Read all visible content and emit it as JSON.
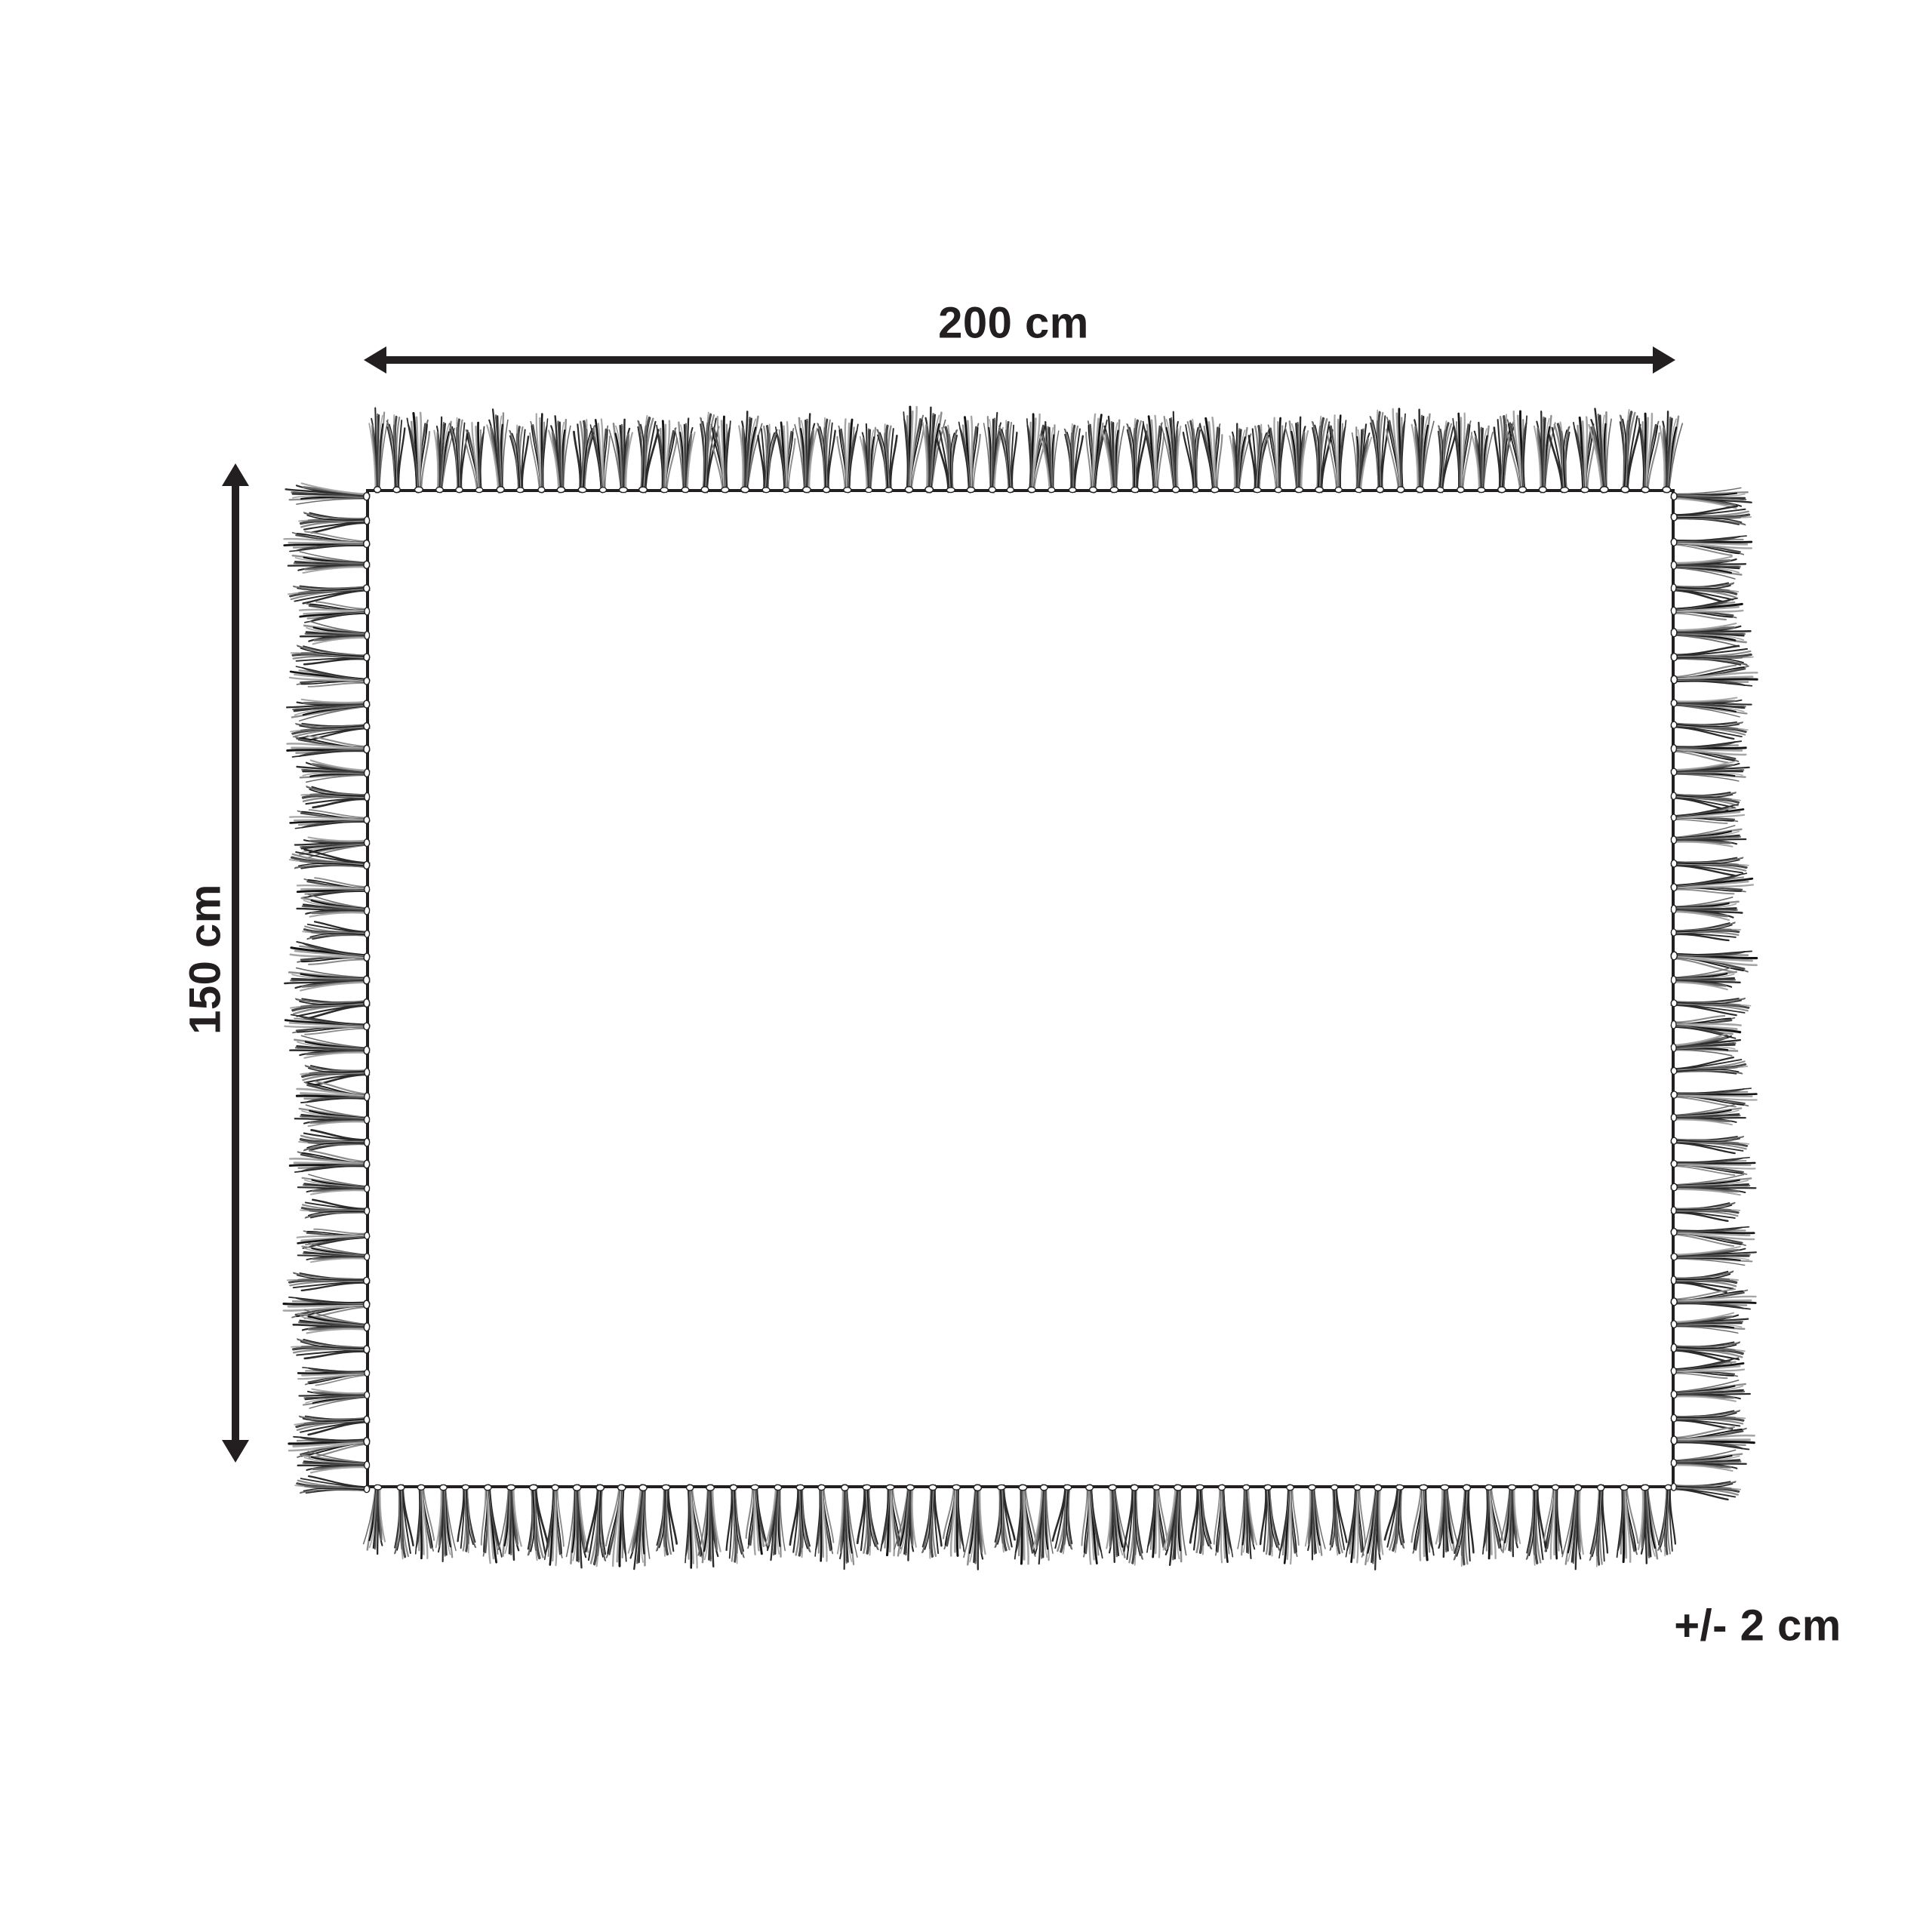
{
  "diagram": {
    "type": "product-dimension-diagram",
    "shape": "rectangle-with-fringe",
    "labels": {
      "width": "200 cm",
      "height": "150 cm",
      "tolerance": "+/- 2 cm"
    },
    "measurements": {
      "width_cm": 200,
      "height_cm": 150,
      "tolerance_cm": 2
    },
    "colors": {
      "ink": "#231f20",
      "background": "#ffffff"
    }
  }
}
